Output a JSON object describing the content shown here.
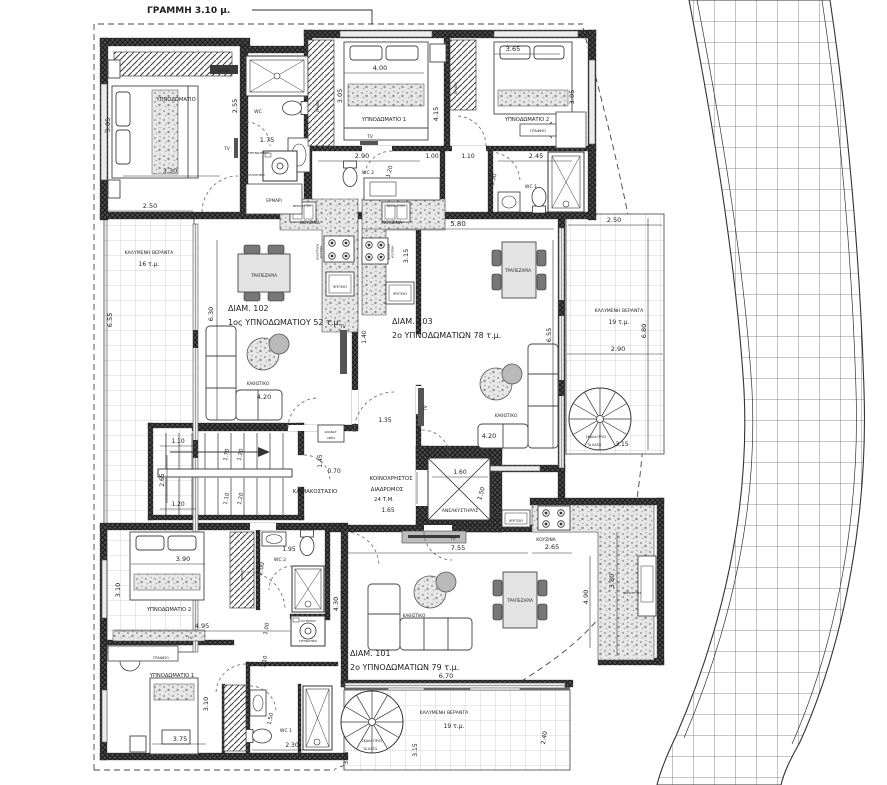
{
  "colors": {
    "line": "#2b2b2b",
    "wall": "#4c4c4c",
    "wall_hatch": "#191919",
    "text": "#1d1d1d",
    "veranda_grid": "#c6c6ca",
    "road_grid": "#6a6a6a",
    "speckle": "#9b9b9b"
  },
  "labels": [
    {
      "name": "note-grammi",
      "text": "ΓΡΑΜΜΗ 3.10 μ.",
      "x": 147,
      "y": 13,
      "size": 9,
      "anchor": "start",
      "bold": true
    },
    {
      "name": "closet-label",
      "text": "ΕΡΜΑΡΙ",
      "x": 224,
      "y": 72,
      "size": 3.2,
      "color": "#ffffff"
    },
    {
      "name": "dim-label",
      "text": "3.05",
      "x": 110,
      "y": 125,
      "size": 6.5,
      "rot": -90
    },
    {
      "name": "room-label",
      "text": "ΥΠΝΟΔΩΜΑΤΙΟ",
      "x": 176,
      "y": 101,
      "size": 5.2
    },
    {
      "name": "tv-label",
      "text": "TV",
      "x": 227,
      "y": 150,
      "size": 4.2
    },
    {
      "name": "dim-label",
      "text": "3.30",
      "x": 170,
      "y": 173,
      "size": 6.5
    },
    {
      "name": "dim-label",
      "text": "2.50",
      "x": 150,
      "y": 208,
      "size": 6.5
    },
    {
      "name": "room-label",
      "text": "WC",
      "x": 258,
      "y": 113,
      "size": 4.6
    },
    {
      "name": "dim-label",
      "text": "2.55",
      "x": 237,
      "y": 106,
      "size": 6.5,
      "rot": -90
    },
    {
      "name": "dim-label",
      "text": "1.75",
      "x": 267,
      "y": 142,
      "size": 6.5
    },
    {
      "name": "fixture-label",
      "text": "ΣΤΕΓΝΩΤΗΡΙΟ",
      "x": 258,
      "y": 154,
      "size": 3
    },
    {
      "name": "fixture-label",
      "text": "ΠΛΥΝΤΗΡΙΟ",
      "x": 256,
      "y": 176,
      "size": 3
    },
    {
      "name": "closet-label",
      "text": "ΕΡΜΑΡΙ",
      "x": 274,
      "y": 202,
      "size": 4.2
    },
    {
      "name": "closet-label",
      "text": "ΕΡΜΑΡΙ",
      "x": 319,
      "y": 106,
      "size": 3.2,
      "rot": -90
    },
    {
      "name": "room-label",
      "text": "ΥΠΝΟΔΩΜΑΤΙΟ 1",
      "x": 384,
      "y": 121,
      "size": 5.2
    },
    {
      "name": "dim-label",
      "text": "4.00",
      "x": 380,
      "y": 70,
      "size": 6.5
    },
    {
      "name": "dim-label",
      "text": "3.05",
      "x": 342,
      "y": 96,
      "size": 6.5,
      "rot": -90
    },
    {
      "name": "dim-label",
      "text": "4.15",
      "x": 438,
      "y": 114,
      "size": 6.5,
      "rot": -90
    },
    {
      "name": "tv-label",
      "text": "TV",
      "x": 370,
      "y": 138,
      "size": 4.2
    },
    {
      "name": "closet-label",
      "text": "ΕΡΜΑΡΙ",
      "x": 457,
      "y": 88,
      "size": 3.2,
      "rot": -90
    },
    {
      "name": "room-label",
      "text": "ΥΠΝΟΔΩΜΑΤΙΟ 2",
      "x": 527,
      "y": 121,
      "size": 5.2
    },
    {
      "name": "dim-label",
      "text": "3.65",
      "x": 513,
      "y": 51,
      "size": 6.5
    },
    {
      "name": "dim-label",
      "text": "3.05",
      "x": 574,
      "y": 97,
      "size": 6.5,
      "rot": -90
    },
    {
      "name": "desk-label",
      "text": "ΓΡΑΦΕΙΟ",
      "x": 538,
      "y": 132,
      "size": 3.6
    },
    {
      "name": "dim-label",
      "text": "2.90",
      "x": 362,
      "y": 158,
      "size": 6.5
    },
    {
      "name": "room-label",
      "text": "WC 2",
      "x": 368,
      "y": 174,
      "size": 4.6
    },
    {
      "name": "dim-label",
      "text": "1.20",
      "x": 391,
      "y": 172,
      "size": 5.5,
      "rot": -75
    },
    {
      "name": "dim-label",
      "text": "1.00",
      "x": 432,
      "y": 158,
      "size": 6
    },
    {
      "name": "dim-label",
      "text": "1.10",
      "x": 468,
      "y": 158,
      "size": 6
    },
    {
      "name": "dim-label",
      "text": "2.45",
      "x": 536,
      "y": 158,
      "size": 6.5
    },
    {
      "name": "dim-label",
      "text": "1.50",
      "x": 495,
      "y": 180,
      "size": 5.5,
      "rot": -75
    },
    {
      "name": "room-label",
      "text": "WC 1",
      "x": 531,
      "y": 188,
      "size": 4.6
    },
    {
      "name": "dim-label",
      "text": "5.80",
      "x": 458,
      "y": 226,
      "size": 7
    },
    {
      "name": "dim-label",
      "text": "2.50",
      "x": 614,
      "y": 222,
      "size": 6.5
    },
    {
      "name": "area-label",
      "text": "ΚΑΛΥΜΕΝΗ ΒΕΡΑΝΤΑ",
      "x": 149,
      "y": 254,
      "size": 4.6
    },
    {
      "name": "area-label",
      "text": "16 τ.μ.",
      "x": 149,
      "y": 266,
      "size": 6
    },
    {
      "name": "dim-label",
      "text": "6.55",
      "x": 112,
      "y": 320,
      "size": 6.5,
      "rot": -90
    },
    {
      "name": "area-label",
      "text": "ΚΟΥΖΙΝΑ",
      "x": 310,
      "y": 224,
      "size": 4.4
    },
    {
      "name": "fixture-label",
      "text": "ΝΕΡΟΧΥΤΗΣ",
      "x": 302,
      "y": 207,
      "size": 3
    },
    {
      "name": "fixture-label",
      "text": "ΗΛΕΚΤΡΙΚΗ",
      "x": 318.5,
      "y": 252,
      "size": 2.8,
      "rot": -90
    },
    {
      "name": "fixture-label",
      "text": "ΚΟΥΖΙΝΑ",
      "x": 322,
      "y": 252,
      "size": 2.8,
      "rot": -90
    },
    {
      "name": "fixture-label",
      "text": "ΨΥΓΕΙΟ",
      "x": 340,
      "y": 288,
      "size": 3.8
    },
    {
      "name": "area-label",
      "text": "ΚΟΥΖΙΝΑ",
      "x": 392,
      "y": 224,
      "size": 4.4
    },
    {
      "name": "fixture-label",
      "text": "ΝΕΡΟΧΥΤΗΣ",
      "x": 396,
      "y": 207,
      "size": 3
    },
    {
      "name": "fixture-label",
      "text": "ΗΛΕΚΤΡΙΚΗ",
      "x": 390,
      "y": 252,
      "size": 2.8,
      "rot": -90
    },
    {
      "name": "fixture-label",
      "text": "ΚΟΥΖΙΝΑ",
      "x": 393.5,
      "y": 252,
      "size": 2.8,
      "rot": -90
    },
    {
      "name": "fixture-label",
      "text": "ΨΥΓΕΙΟ",
      "x": 400,
      "y": 295,
      "size": 3.8
    },
    {
      "name": "dim-label",
      "text": "3.15",
      "x": 408,
      "y": 256,
      "size": 6.5,
      "rot": -90
    },
    {
      "name": "furn-label",
      "text": "ΤΡΑΠΕΖΑΡΙΑ",
      "x": 264,
      "y": 277,
      "size": 4.2
    },
    {
      "name": "apt-name",
      "text": "ΔΙΑΜ. 102",
      "x": 228,
      "y": 311,
      "size": 8,
      "anchor": "start"
    },
    {
      "name": "apt-type",
      "text": "1ος  ΥΠΝΟΔΩΜΑΤΙΟΥ 52 τ.μ.",
      "x": 228,
      "y": 325,
      "size": 8,
      "anchor": "start"
    },
    {
      "name": "dim-label",
      "text": "6.30",
      "x": 213,
      "y": 314,
      "size": 6.5,
      "rot": -90
    },
    {
      "name": "furn-label",
      "text": "ΚΑΘΙΣΤΙΚΟ",
      "x": 258,
      "y": 385,
      "size": 4.2
    },
    {
      "name": "dim-label",
      "text": "4.20",
      "x": 264,
      "y": 399,
      "size": 6.5
    },
    {
      "name": "tv-label",
      "text": "TV",
      "x": 343,
      "y": 328,
      "size": 4
    },
    {
      "name": "dim-label",
      "text": "1.40",
      "x": 366,
      "y": 337,
      "size": 6,
      "rot": -90
    },
    {
      "name": "furn-label",
      "text": "ΤΡΑΠΕΖΑΡΙΑ",
      "x": 518,
      "y": 272,
      "size": 4.2
    },
    {
      "name": "apt-name",
      "text": "ΔΙΑΜ. 103",
      "x": 392,
      "y": 324,
      "size": 8,
      "anchor": "start"
    },
    {
      "name": "apt-type",
      "text": "2ο ΥΠΝΟΔΩΜΑΤΙΩΝ 78 τ.μ.",
      "x": 392,
      "y": 338,
      "size": 8,
      "anchor": "start"
    },
    {
      "name": "dim-label",
      "text": "6.55",
      "x": 551,
      "y": 335,
      "size": 6.5,
      "rot": -90
    },
    {
      "name": "furn-label",
      "text": "ΚΑΘΙΣΤΙΚΟ",
      "x": 506,
      "y": 417,
      "size": 4.2
    },
    {
      "name": "dim-label",
      "text": "4.20",
      "x": 489,
      "y": 438,
      "size": 6.5
    },
    {
      "name": "tv-label",
      "text": "TV",
      "x": 427,
      "y": 408,
      "size": 4,
      "rot": -90
    },
    {
      "name": "dim-label",
      "text": "1.35",
      "x": 385,
      "y": 422,
      "size": 6
    },
    {
      "name": "fixture-label",
      "text": "ΑΝΑΒΑΤ.",
      "x": 331,
      "y": 433,
      "size": 3
    },
    {
      "name": "fixture-label",
      "text": "ΑΜΕΑ",
      "x": 331,
      "y": 439,
      "size": 3
    },
    {
      "name": "area-label",
      "text": "ΚΑΛΥΜΕΝΗ ΒΕΡΑΝΤΑ",
      "x": 619,
      "y": 312,
      "size": 4.6
    },
    {
      "name": "area-label",
      "text": "19 τ.μ.",
      "x": 619,
      "y": 324,
      "size": 6
    },
    {
      "name": "dim-label",
      "text": "6.80",
      "x": 646,
      "y": 331,
      "size": 6.5,
      "rot": -90
    },
    {
      "name": "dim-label",
      "text": "2.90",
      "x": 618,
      "y": 351,
      "size": 6.5
    },
    {
      "name": "stair-label",
      "text": "ΣΚΑΛΑ ΠΡΟΣ",
      "x": 596,
      "y": 438,
      "size": 3.2
    },
    {
      "name": "stair-label",
      "text": "ΤΑ ΚΑΤΩ",
      "x": 594,
      "y": 446,
      "size": 3.2
    },
    {
      "name": "dim-label",
      "text": "3.15",
      "x": 622,
      "y": 446,
      "size": 6
    },
    {
      "name": "room-label",
      "text": "ΚΛΙΜΑΚΟΣΤΑΣΙΟ",
      "x": 315,
      "y": 493,
      "size": 5.4
    },
    {
      "name": "dim-label",
      "text": "1.10",
      "x": 178,
      "y": 443,
      "size": 6
    },
    {
      "name": "dim-label",
      "text": "2.65",
      "x": 164,
      "y": 480,
      "size": 6,
      "rot": -90
    },
    {
      "name": "dim-label",
      "text": "1.20",
      "x": 178,
      "y": 506,
      "size": 6
    },
    {
      "name": "dim-label",
      "text": "1.70",
      "x": 228,
      "y": 455,
      "size": 5.5,
      "rot": -80
    },
    {
      "name": "dim-label",
      "text": "1.20",
      "x": 242,
      "y": 455,
      "size": 5.5,
      "rot": -80
    },
    {
      "name": "dim-label",
      "text": "1.10",
      "x": 228,
      "y": 499,
      "size": 5.5,
      "rot": -80
    },
    {
      "name": "dim-label",
      "text": "1.20",
      "x": 242,
      "y": 499,
      "size": 5.5,
      "rot": -80
    },
    {
      "name": "dim-label",
      "text": "1.45",
      "x": 322,
      "y": 461,
      "size": 6,
      "rot": -90
    },
    {
      "name": "dim-label",
      "text": "0.70",
      "x": 334,
      "y": 473,
      "size": 6
    },
    {
      "name": "room-label",
      "text": "ΚΟΙΝΟΧΡΗΣΤΟΣ",
      "x": 391,
      "y": 480,
      "size": 5.4
    },
    {
      "name": "room-label",
      "text": "ΔΙΑΔΡΟΜΟΣ",
      "x": 387,
      "y": 491,
      "size": 5.4
    },
    {
      "name": "room-label",
      "text": "24 Τ.Μ.",
      "x": 384,
      "y": 501,
      "size": 5.4
    },
    {
      "name": "dim-label",
      "text": "1.65",
      "x": 388,
      "y": 512,
      "size": 6
    },
    {
      "name": "dim-label",
      "text": "1.60",
      "x": 460,
      "y": 474,
      "size": 6
    },
    {
      "name": "dim-label",
      "text": "1.50",
      "x": 483,
      "y": 494,
      "size": 6,
      "rot": -75
    },
    {
      "name": "room-label",
      "text": "ΑΝΕΛΚΥΣΤΗΡΑΣ",
      "x": 460,
      "y": 512,
      "size": 4.6
    },
    {
      "name": "tv-label",
      "text": "TV",
      "x": 453,
      "y": 540,
      "size": 3.8
    },
    {
      "name": "dim-label",
      "text": "7.55",
      "x": 458,
      "y": 550,
      "size": 6.5
    },
    {
      "name": "area-label",
      "text": "ΚΟΥΖΙΝΑ",
      "x": 546,
      "y": 541,
      "size": 4.4
    },
    {
      "name": "dim-label",
      "text": "2.65",
      "x": 552,
      "y": 549,
      "size": 6.5
    },
    {
      "name": "fixture-label",
      "text": "ΨΥΓΕΙΟ",
      "x": 516,
      "y": 522,
      "size": 3.8
    },
    {
      "name": "fixture-label",
      "text": "ΝΕΡΟΧΥΤΗΣ",
      "x": 632,
      "y": 594,
      "size": 3
    },
    {
      "name": "dim-label",
      "text": "3.80",
      "x": 614,
      "y": 581,
      "size": 6.5,
      "rot": -90
    },
    {
      "name": "dim-label",
      "text": "4.90",
      "x": 588,
      "y": 597,
      "size": 6.5,
      "rot": -90
    },
    {
      "name": "furn-label",
      "text": "ΚΑΘΙΣΤΙΚΟ",
      "x": 414,
      "y": 617,
      "size": 4.2
    },
    {
      "name": "furn-label",
      "text": "ΤΡΑΠΕΖΑΡΙΑ",
      "x": 520,
      "y": 602,
      "size": 4.2
    },
    {
      "name": "apt-name",
      "text": "ΔΙΑΜ. 101",
      "x": 350,
      "y": 656,
      "size": 8,
      "anchor": "start"
    },
    {
      "name": "apt-type",
      "text": "2ο ΥΠΝΟΔΩΜΑΤΙΩΝ 79 τ.μ.",
      "x": 350,
      "y": 670,
      "size": 8,
      "anchor": "start"
    },
    {
      "name": "dim-label",
      "text": "6.70",
      "x": 446,
      "y": 678,
      "size": 6.5
    },
    {
      "name": "dim-label",
      "text": "4.30",
      "x": 338,
      "y": 604,
      "size": 6.5,
      "rot": -90
    },
    {
      "name": "room-label",
      "text": "ΥΠΝΟΔΩΜΑΤΙΟ 2",
      "x": 169,
      "y": 611,
      "size": 5.2
    },
    {
      "name": "dim-label",
      "text": "3.90",
      "x": 183,
      "y": 561,
      "size": 6.5
    },
    {
      "name": "dim-label",
      "text": "3.10",
      "x": 120,
      "y": 590,
      "size": 6.5,
      "rot": -90
    },
    {
      "name": "dim-label",
      "text": "4.95",
      "x": 202,
      "y": 628,
      "size": 6.5
    },
    {
      "name": "tv-label",
      "text": "TV",
      "x": 190,
      "y": 639,
      "size": 3.8
    },
    {
      "name": "closet-label",
      "text": "ΕΡΜΑΡΙ",
      "x": 243,
      "y": 575,
      "size": 3,
      "rot": -90
    },
    {
      "name": "dim-label",
      "text": "1.95",
      "x": 289,
      "y": 551,
      "size": 6
    },
    {
      "name": "room-label",
      "text": "WC 2",
      "x": 280,
      "y": 561,
      "size": 4.6
    },
    {
      "name": "dim-label",
      "text": "2.00",
      "x": 263,
      "y": 569,
      "size": 6,
      "rot": -80
    },
    {
      "name": "fixture-label",
      "text": "ΠΛΥΝΤΗΡΙΟ",
      "x": 308,
      "y": 622,
      "size": 2.6
    },
    {
      "name": "fixture-label",
      "text": "ΣΤΕΓΝΩΤΗΡΙΟ",
      "x": 308,
      "y": 642,
      "size": 2.6
    },
    {
      "name": "dim-label",
      "text": "1.00",
      "x": 268,
      "y": 629,
      "size": 5.5,
      "rot": -80
    },
    {
      "name": "dim-label",
      "text": "1.10",
      "x": 266,
      "y": 662,
      "size": 5.5,
      "rot": -80
    },
    {
      "name": "desk-label",
      "text": "ΓΡΑΦΕΙΟ",
      "x": 161,
      "y": 659,
      "size": 3.6
    },
    {
      "name": "room-label",
      "text": "ΥΠΝΟΔΩΜΑΤΙΟ 1",
      "x": 172,
      "y": 677,
      "size": 5.2
    },
    {
      "name": "dim-label",
      "text": "3.10",
      "x": 208,
      "y": 704,
      "size": 6.5,
      "rot": -90
    },
    {
      "name": "dim-label",
      "text": "3.75",
      "x": 180,
      "y": 741,
      "size": 6.5
    },
    {
      "name": "room-label",
      "text": "WC 1",
      "x": 286,
      "y": 732,
      "size": 4.6
    },
    {
      "name": "dim-label",
      "text": "1.50",
      "x": 272,
      "y": 719,
      "size": 5.5,
      "rot": -80
    },
    {
      "name": "dim-label",
      "text": "2.30",
      "x": 292,
      "y": 747,
      "size": 6
    },
    {
      "name": "area-label",
      "text": "ΚΑΛΥΜΕΝΗ ΒΕΡΑΝΤΑ",
      "x": 444,
      "y": 714,
      "size": 4.6
    },
    {
      "name": "area-label",
      "text": "19 τ.μ.",
      "x": 454,
      "y": 728,
      "size": 6
    },
    {
      "name": "stair-label",
      "text": "ΣΚΑΛΑ ΠΡΟΣ",
      "x": 372,
      "y": 742,
      "size": 3.2
    },
    {
      "name": "stair-label",
      "text": "ΤΑ ΚΑΤΩ",
      "x": 370,
      "y": 750,
      "size": 3.2
    },
    {
      "name": "dim-label",
      "text": "3.15",
      "x": 417,
      "y": 750,
      "size": 6,
      "rot": -90
    },
    {
      "name": "dim-label",
      "text": "2.40",
      "x": 546,
      "y": 738,
      "size": 6,
      "rot": -80
    },
    {
      "name": "dim-label",
      "text": "3.55",
      "x": 348,
      "y": 758,
      "size": 6,
      "rot": -90
    }
  ]
}
